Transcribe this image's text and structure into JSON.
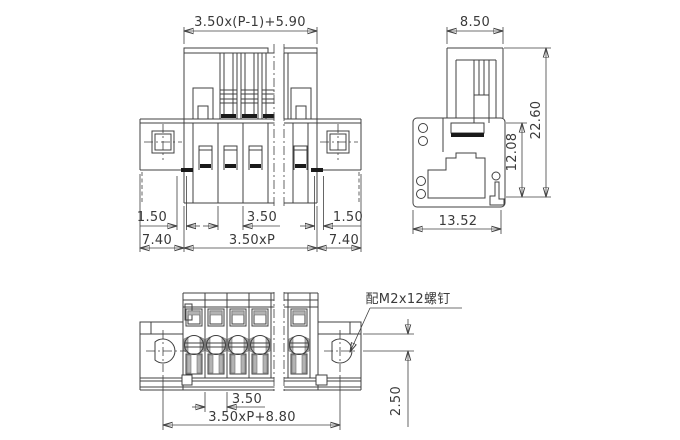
{
  "front_view": {
    "dim_top_span": "3.50x(P-1)+5.90",
    "dim_wall_left": "1.50",
    "dim_pitch": "3.50",
    "dim_wall_right": "1.50",
    "dim_flange_left": "7.40",
    "dim_body_span": "3.50xP",
    "dim_flange_right": "7.40"
  },
  "side_view": {
    "dim_width": "8.50",
    "dim_inner_height": "12.08",
    "dim_total_height": "22.60",
    "dim_base_width": "13.52"
  },
  "plan_view": {
    "screw_note": "配M2x12螺钉",
    "dim_pitch": "3.50",
    "dim_mounting_span": "3.50xP+8.80",
    "dim_hole_offset": "2.50"
  },
  "colors": {
    "line": "#404040",
    "dark_fill": "#1a1a1a",
    "gray_fill": "#b3b3b3",
    "text": "#3a3a3a",
    "background": "#ffffff"
  }
}
